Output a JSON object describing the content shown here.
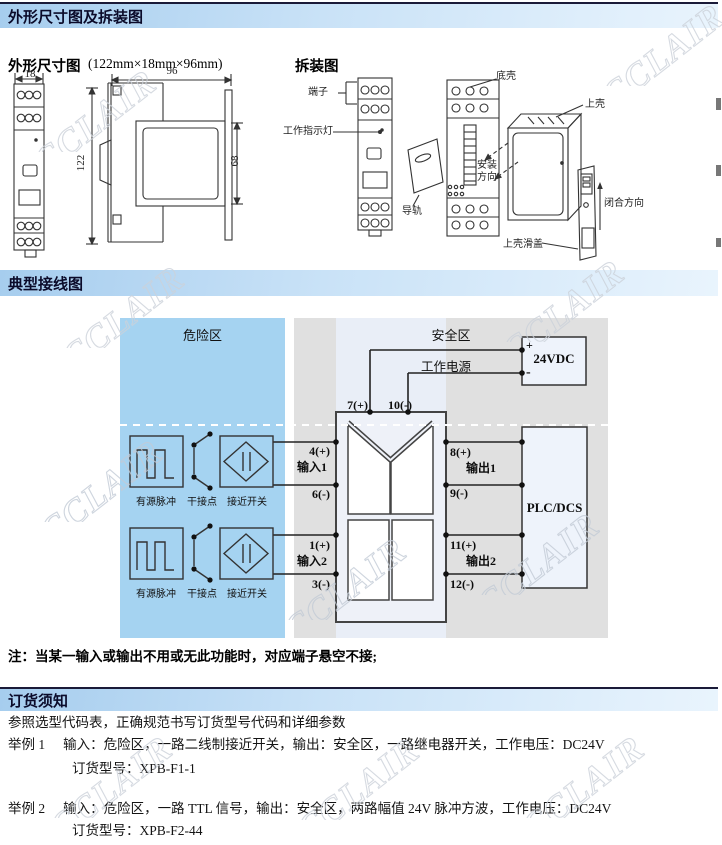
{
  "watermark": "CCLAIR",
  "sections": {
    "dimension": {
      "title": "外形尺寸图及拆装图"
    },
    "wiring": {
      "title": "典型接线图"
    },
    "ordering": {
      "title": "订货须知"
    }
  },
  "dimension": {
    "subtitle": "外形尺寸图",
    "size_note": "(122mm×18mm×96mm)",
    "disassembly_title": "拆装图",
    "dims": {
      "width": "18",
      "depth": "96",
      "height": "122",
      "face": "68"
    },
    "labels": {
      "terminal": "端子",
      "indicator": "工作指示灯",
      "bottom_shell": "底壳",
      "top_shell": "上壳",
      "install_dir": "安装方向",
      "rail": "导轨",
      "close_dir": "闭合方向",
      "slide_cover": "上壳滑盖"
    }
  },
  "wiring": {
    "hazard_zone": "危险区",
    "safe_zone": "安全区",
    "power_label": "工作电源",
    "power_plus": "+",
    "power_name": "24VDC",
    "power_minus": "-",
    "plc": "PLC/DCS",
    "top_terminals": {
      "t7": "7(+)",
      "t10": "10(-)"
    },
    "inputs": [
      {
        "pos": "4(+)",
        "name": "输入1",
        "neg": "6(-)"
      },
      {
        "pos": "1(+)",
        "name": "输入2",
        "neg": "3(-)"
      }
    ],
    "outputs": [
      {
        "pos": "8(+)",
        "name": "输出1",
        "neg": "9(-)"
      },
      {
        "pos": "11(+)",
        "name": "输出2",
        "neg": "12(-)"
      }
    ],
    "sensors": [
      {
        "pulse": "有源脉冲",
        "contact": "干接点",
        "proximity": "接近开关"
      },
      {
        "pulse": "有源脉冲",
        "contact": "干接点",
        "proximity": "接近开关"
      }
    ]
  },
  "note": "注：当某一输入或输出不用或无此功能时，对应端子悬空不接;",
  "ordering": {
    "intro": "参照选型代码表，正确规范书写订货型号代码和详细参数",
    "examples": [
      {
        "label": "举例 1",
        "desc": "输入：危险区，一路二线制接近开关，输出：安全区，一路继电器开关，工作电压：DC24V",
        "model": "订货型号：XPB-F1-1"
      },
      {
        "label": "举例 2",
        "desc": "输入：危险区，一路 TTL 信号，输出：安全区，两路幅值 24V 脉冲方波，工作电压：DC24V",
        "model": "订货型号：XPB-F2-44"
      }
    ]
  }
}
